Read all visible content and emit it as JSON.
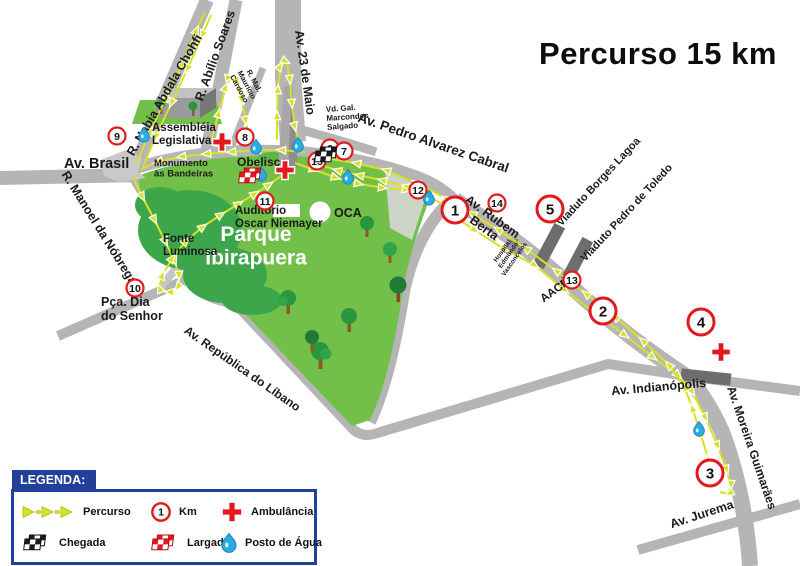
{
  "title": "Percurso 15 km",
  "legend": {
    "header": "LEGENDA:",
    "items": [
      {
        "icon": "route-arrows",
        "label": "Percurso"
      },
      {
        "icon": "km-circle",
        "label": "Km",
        "symbol": "1"
      },
      {
        "icon": "ambulance-cross",
        "label": "Ambulância"
      },
      {
        "icon": "finish-flag",
        "label": "Chegada"
      },
      {
        "icon": "start-flag",
        "label": "Largada"
      },
      {
        "icon": "water-drop",
        "label": "Posto de Água"
      }
    ]
  },
  "colors": {
    "route_yellow": "#d9e125",
    "arrow_yellow": "#d7e322",
    "road_gray": "#b5b5b5",
    "viaduct_gray": "#6d6d6d",
    "park_green": "#72c04a",
    "park_dark_green": "#3da64b",
    "marker_red": "#e3191e",
    "water_blue": "#2aabe2",
    "navy": "#21409a",
    "label": "#1a1a1a"
  },
  "map": {
    "labels": [
      {
        "name": "label-r-nabia-abdala-chohfi",
        "text": "R. Nabia Abdala Chohfi",
        "x": 168,
        "y": 97,
        "rotate": -60,
        "size": 12.5
      },
      {
        "name": "label-r-abilio-soares",
        "text": "R. Abílio Soares",
        "x": 219,
        "y": 57,
        "rotate": -70,
        "size": 12.5
      },
      {
        "name": "label-av-23-de-maio",
        "text": "Av. 23 de Maio",
        "x": 301,
        "y": 73,
        "rotate": 82,
        "size": 12.5
      },
      {
        "name": "label-r-mal-mauricio-cardoso",
        "lines": [
          "R. Mal.",
          "Maurício",
          "Cardoso"
        ],
        "x": 252,
        "y": 82,
        "rotate": 62,
        "size": 7.5
      },
      {
        "name": "label-vd-gal-marcondes-salgado",
        "lines": [
          "Vd. Gal.",
          "Marcondes",
          "Salgado"
        ],
        "x": 326,
        "y": 112,
        "rotate": -4,
        "size": 8,
        "anchor": "start"
      },
      {
        "name": "label-av-pedro-alvarez-cabral",
        "text": "Av. Pedro Alvarez Cabral",
        "x": 432,
        "y": 147,
        "rotate": 19,
        "size": 13.5
      },
      {
        "name": "label-av-brasil",
        "text": "Av. Brasil",
        "x": 64,
        "y": 168,
        "rotate": 0,
        "size": 14.5,
        "anchor": "start"
      },
      {
        "name": "label-r-manoel-da-nobrega",
        "text": "R. Manoel da Nóbrega",
        "x": 96,
        "y": 230,
        "rotate": 58,
        "size": 12.5
      },
      {
        "name": "label-pca-dia-do-senhor",
        "lines": [
          "Pça. Dia",
          "do Senhor"
        ],
        "x": 101,
        "y": 306,
        "size": 12.5,
        "anchor": "start"
      },
      {
        "name": "label-av-republica-do-libano",
        "text": "Av. República do Líbano",
        "x": 240,
        "y": 372,
        "rotate": 35,
        "size": 12
      },
      {
        "name": "label-av-rubem-berta",
        "lines": [
          "Av. Rubem",
          "Berta"
        ],
        "x": 490,
        "y": 220,
        "rotate": 36,
        "size": 12.5
      },
      {
        "name": "label-viaduto-borges-lagoa",
        "text": "Viaduto Borges Lagoa",
        "x": 601,
        "y": 184,
        "rotate": -47,
        "size": 11
      },
      {
        "name": "label-viaduto-pedro-de-toledo",
        "text": "Viaduto Pedro de Toledo",
        "x": 629,
        "y": 215,
        "rotate": -47,
        "size": 11
      },
      {
        "name": "label-aacd",
        "text": "AACD",
        "x": 557,
        "y": 293,
        "rotate": -36,
        "size": 11.5
      },
      {
        "name": "label-hospital-edmundo-vasconcelos",
        "lines": [
          "Hospital",
          "Edmundo",
          "Vasconcelos"
        ],
        "x": 504,
        "y": 252,
        "rotate": -55,
        "size": 6.5
      },
      {
        "name": "label-av-indianopolis",
        "text": "Av. Indianópolis",
        "x": 659,
        "y": 391,
        "rotate": -5,
        "size": 12.5
      },
      {
        "name": "label-av-moreira-guimaraes",
        "text": "Av. Moreira Guimarães",
        "x": 748,
        "y": 449,
        "rotate": 71,
        "size": 12
      },
      {
        "name": "label-av-jurema",
        "text": "Av. Jurema",
        "x": 703,
        "y": 518,
        "rotate": -18,
        "size": 12.5
      },
      {
        "name": "label-assembleia-legislativa",
        "lines": [
          "Assembléia",
          "Legislativa"
        ],
        "x": 152,
        "y": 131,
        "size": 11.5,
        "anchor": "start"
      },
      {
        "name": "label-monumento-as-bandeiras",
        "lines": [
          "Monumento",
          "às Bandeiras"
        ],
        "x": 154,
        "y": 166,
        "size": 9.5,
        "anchor": "start"
      },
      {
        "name": "label-obelisco",
        "text": "Obelisco",
        "x": 237,
        "y": 166,
        "size": 12,
        "anchor": "start"
      },
      {
        "name": "label-auditorio-oscar-niemayer",
        "lines": [
          "Auditório",
          "Oscar Niemayer"
        ],
        "x": 235,
        "y": 214,
        "size": 11.5,
        "anchor": "start"
      },
      {
        "name": "label-parque-ibirapuera",
        "lines": [
          "Parque",
          "Ibirapuera"
        ],
        "x": 256,
        "y": 241,
        "size": 21,
        "fill": "#ffffff",
        "anchor": "middle"
      },
      {
        "name": "label-fonte-luminosa",
        "lines": [
          "Fonte",
          "Luminosa"
        ],
        "x": 163,
        "y": 242,
        "size": 11.5,
        "anchor": "start"
      },
      {
        "name": "label-oca",
        "text": "OCA",
        "x": 334,
        "y": 217,
        "size": 12.5,
        "anchor": "start"
      }
    ],
    "km_markers": [
      {
        "n": "1",
        "x": 455,
        "y": 210,
        "big": true
      },
      {
        "n": "2",
        "x": 603,
        "y": 311,
        "big": true
      },
      {
        "n": "3",
        "x": 710,
        "y": 473,
        "big": true
      },
      {
        "n": "4",
        "x": 701,
        "y": 322,
        "big": true
      },
      {
        "n": "5",
        "x": 550,
        "y": 209,
        "big": true
      },
      {
        "n": "6",
        "x": 330,
        "y": 148
      },
      {
        "n": "7",
        "x": 344,
        "y": 151
      },
      {
        "n": "8",
        "x": 245,
        "y": 137
      },
      {
        "n": "9",
        "x": 117,
        "y": 136
      },
      {
        "n": "10",
        "x": 135,
        "y": 288
      },
      {
        "n": "11",
        "x": 265,
        "y": 201
      },
      {
        "n": "12",
        "x": 418,
        "y": 190
      },
      {
        "n": "13",
        "x": 572,
        "y": 280
      },
      {
        "n": "14",
        "x": 497,
        "y": 203
      },
      {
        "n": "15",
        "x": 317,
        "y": 161
      }
    ],
    "ambulance_positions": [
      {
        "x": 222,
        "y": 142
      },
      {
        "x": 285,
        "y": 170
      },
      {
        "x": 721,
        "y": 352
      }
    ],
    "water_stop_positions": [
      {
        "x": 144,
        "y": 134
      },
      {
        "x": 256,
        "y": 146
      },
      {
        "x": 298,
        "y": 144
      },
      {
        "x": 261,
        "y": 173
      },
      {
        "x": 348,
        "y": 176
      },
      {
        "x": 429,
        "y": 197
      },
      {
        "x": 699,
        "y": 428
      }
    ],
    "flags": {
      "start": {
        "x": 250,
        "y": 178
      },
      "finish": {
        "x": 326,
        "y": 157
      }
    }
  }
}
